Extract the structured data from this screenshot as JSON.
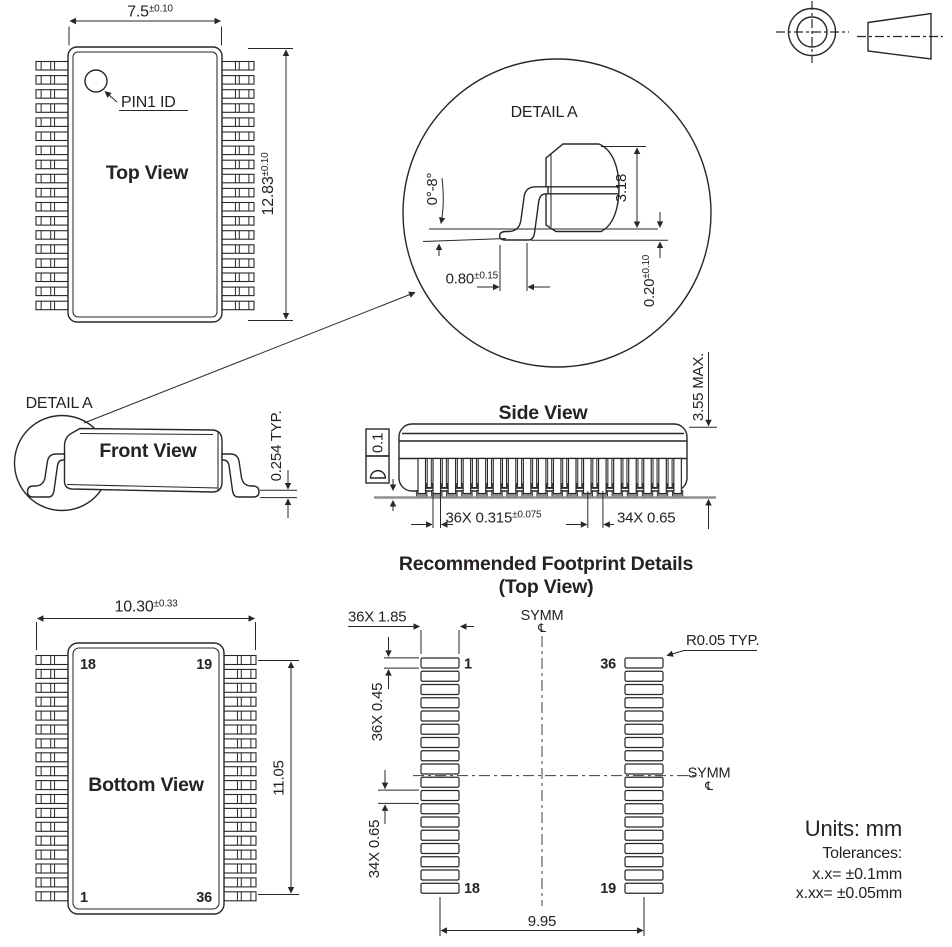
{
  "colors": {
    "line": "#2a2627",
    "gray": "#8f8f8f"
  },
  "counts": {
    "pins_per_side": 18,
    "pads_per_column": 18,
    "side_leads_front": 18,
    "side_leads_back": 17
  },
  "top_view": {
    "title": "Top View",
    "pin1_label": "PIN1 ID",
    "width_val": "7.5",
    "width_tol": "±0.10",
    "height_val": "12.83",
    "height_tol": "±0.10"
  },
  "detail_a": {
    "label": "DETAIL A",
    "angle": "0°-8°",
    "height": "3.18",
    "foot_val": "0.80",
    "foot_tol": "±0.15",
    "standoff_val": "0.20",
    "standoff_tol": "±0.10"
  },
  "front_view": {
    "title": "Front View",
    "detail_label": "DETAIL A",
    "thickness": "0.254 TYP."
  },
  "side_view": {
    "title": "Side View",
    "max_height": "3.55 MAX.",
    "flatness": "0.1",
    "lead_width_val": "36X 0.315",
    "lead_width_tol": "±0.075",
    "lead_pitch": "34X 0.65"
  },
  "footprint": {
    "title": "Recommended Footprint Details",
    "subtitle": "(Top View)",
    "symm": "SYMM",
    "centerline_symbol": "℄",
    "pad_length": "36X 1.85",
    "pad_width": "36X 0.45",
    "pad_pitch": "34X 0.65",
    "corner_radius": "R0.05 TYP.",
    "span": "9.95",
    "pad_first": "1",
    "pad_18": "18",
    "pad_19": "19",
    "pad_36": "36"
  },
  "bottom_view": {
    "title": "Bottom View",
    "width_val": "10.30",
    "width_tol": "±0.33",
    "height": "11.05",
    "pin_18": "18",
    "pin_19": "19",
    "pin_1": "1",
    "pin_36": "36"
  },
  "notes": {
    "units": "Units: mm",
    "tolerances_title": "Tolerances:",
    "tolerance_1": "x.x= ±0.1mm",
    "tolerance_2": "x.xx= ±0.05mm"
  }
}
